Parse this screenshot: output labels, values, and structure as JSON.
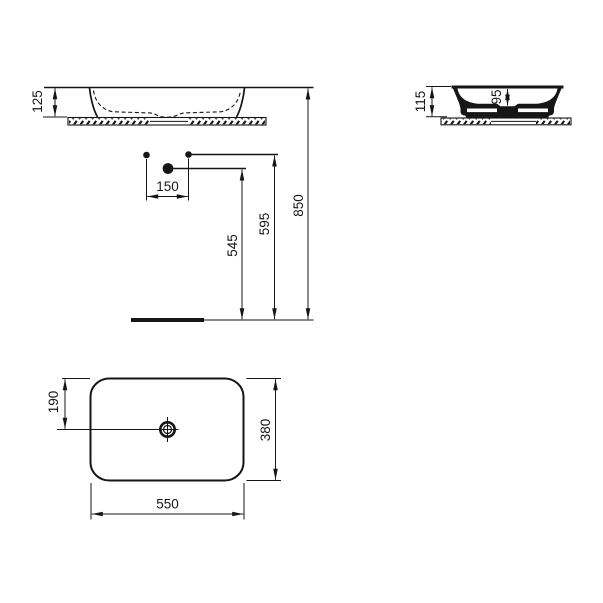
{
  "drawing": {
    "type": "washbasin technical dimension drawing",
    "ink_color": "#161616",
    "background_color": "#ffffff"
  },
  "dims": {
    "front_rim_height": "125",
    "side_total_height": "115",
    "side_bowl_depth": "95",
    "hole_spacing": "150",
    "drain_center_height": "545",
    "hole_line_height": "595",
    "rim_line_height": "850",
    "drain_offset_from_edge": "190",
    "basin_depth": "380",
    "basin_width": "550"
  }
}
